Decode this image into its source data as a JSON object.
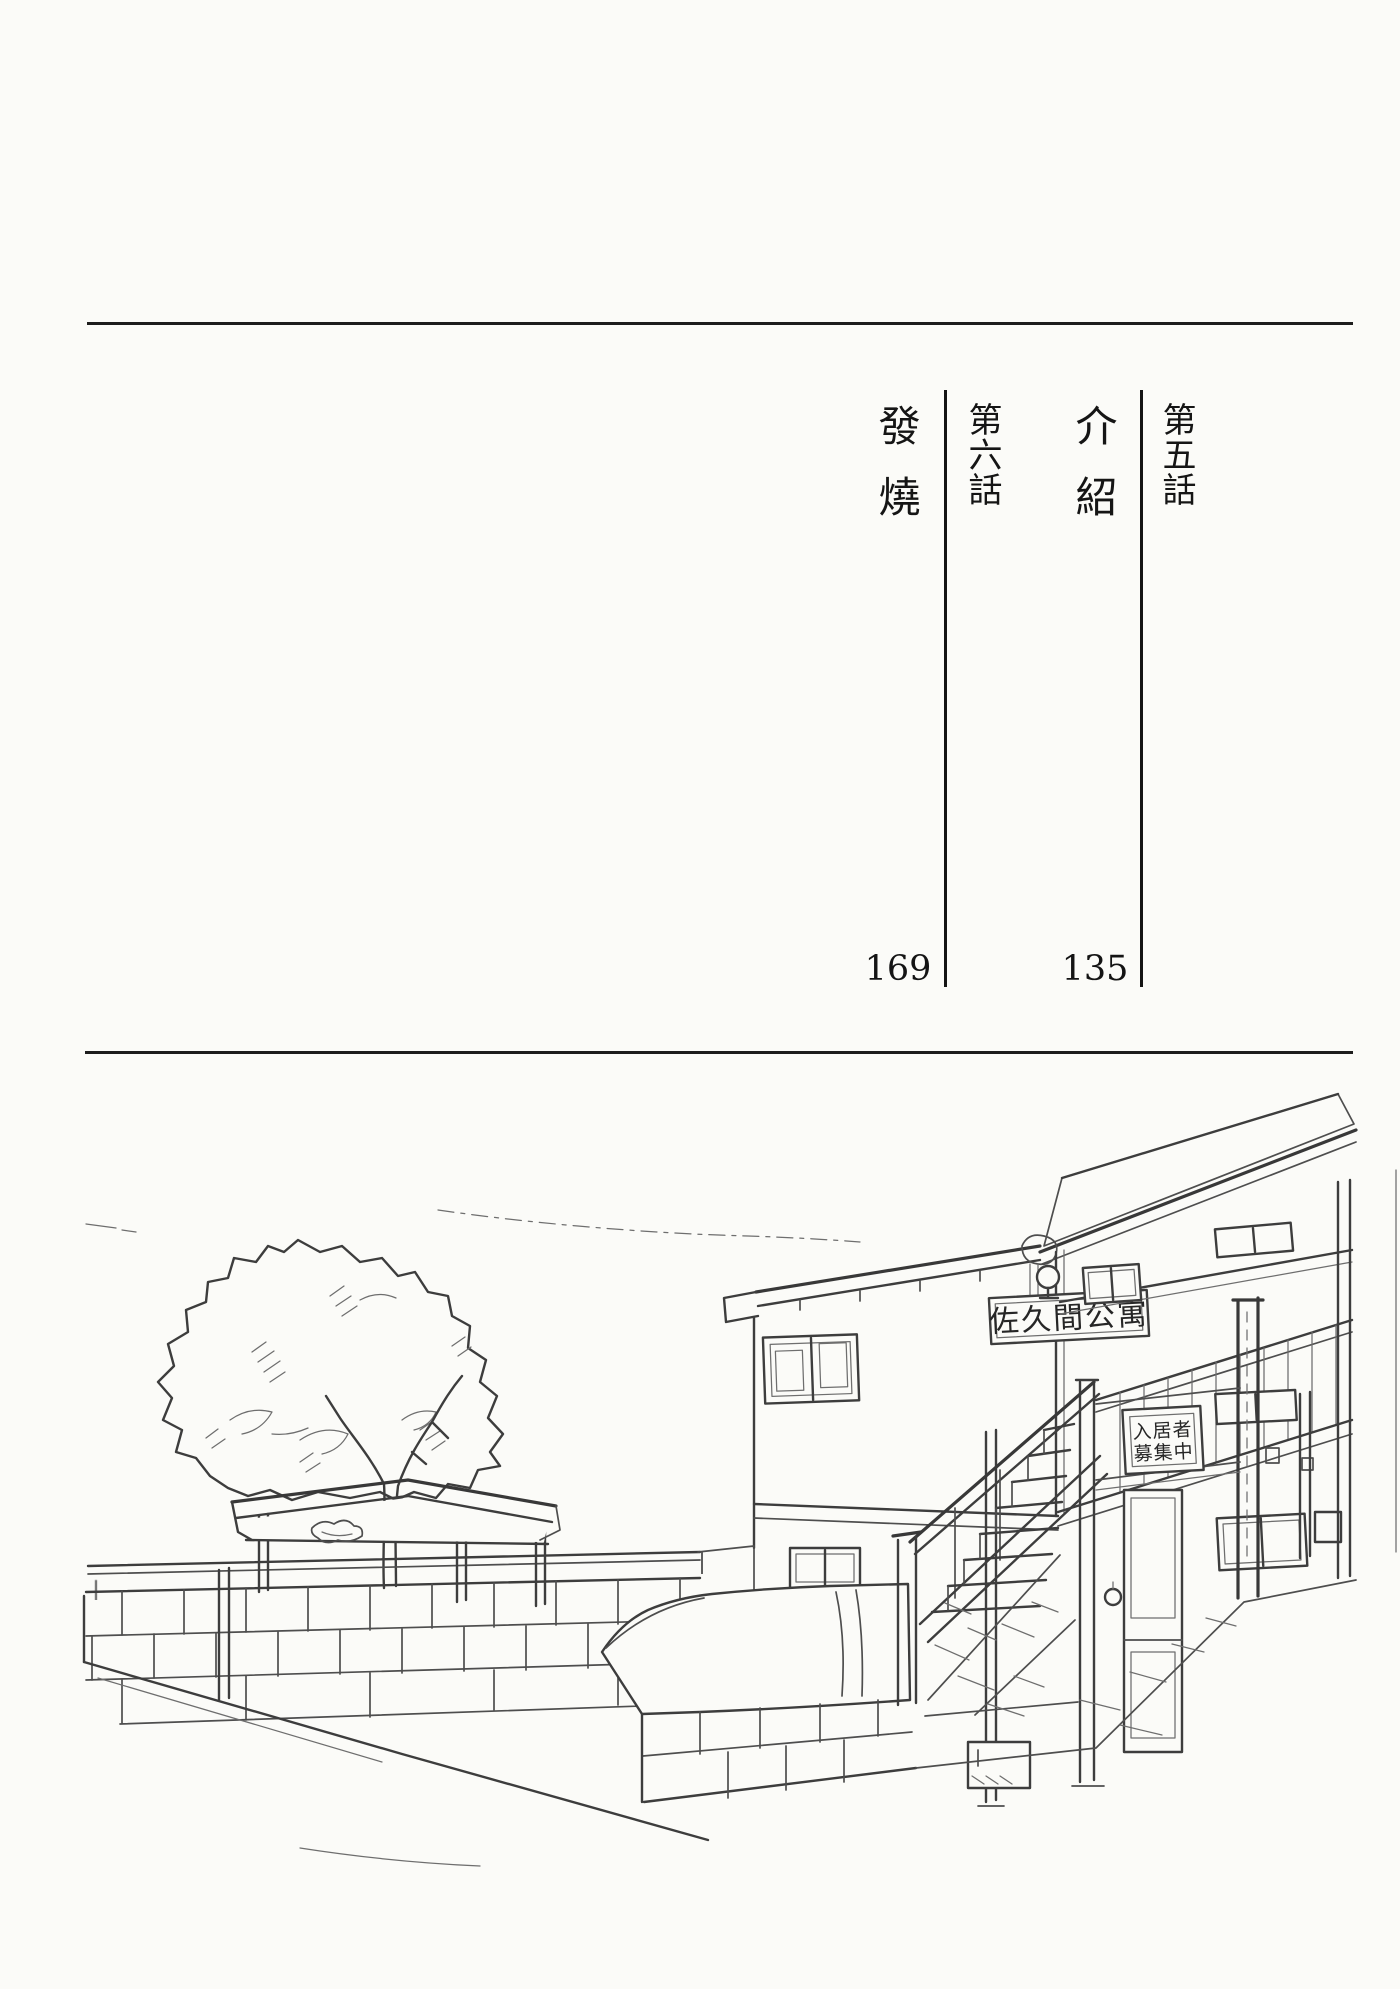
{
  "toc": {
    "entries": [
      {
        "chapter_label": "第五話",
        "title": "介紹",
        "page_number": "135"
      },
      {
        "chapter_label": "第六話",
        "title": "發燒",
        "page_number": "169"
      }
    ]
  },
  "illustration": {
    "building_sign_text": "佐久間公寓",
    "vacancy_sign_line1": "入居者",
    "vacancy_sign_line2": "募集中"
  }
}
